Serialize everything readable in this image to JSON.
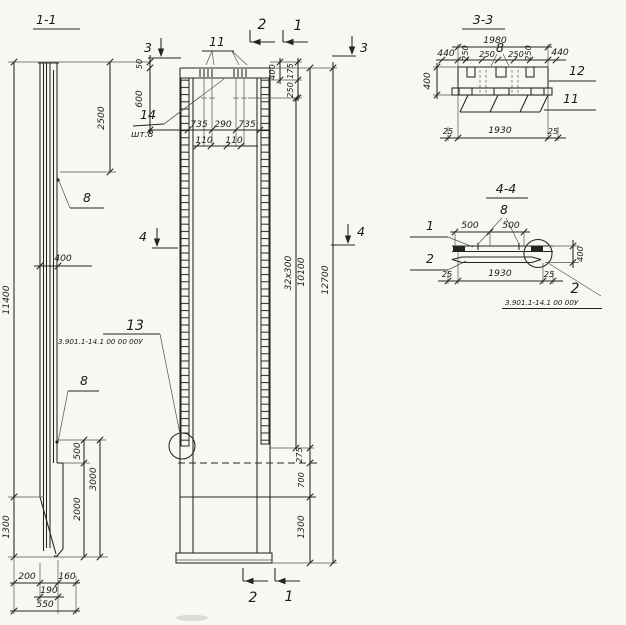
{
  "sheet": {
    "background": "#f8f7f2",
    "ink": "#26241f"
  },
  "section_1_1": {
    "title": "1-1",
    "label_rebar_top": "8",
    "label_rebar_bottom": "8",
    "dim_overall": "11400",
    "dim_top": "2500",
    "dim_width": "400",
    "dim_500": "500",
    "dim_2000": "2000",
    "dim_3000": "3000",
    "dim_1300": "1300",
    "dim_200": "200",
    "dim_160": "160",
    "dim_190": "190",
    "dim_550": "550"
  },
  "elevation": {
    "marker_3_left": "3",
    "marker_3_right": "3",
    "marker_2_top": "2",
    "marker_1_top": "1",
    "marker_4_left": "4",
    "marker_4_right": "4",
    "marker_2_bottom": "2",
    "marker_1_bottom": "1",
    "label_11": "11",
    "label_14": "14",
    "label_14_qty": "шт.8",
    "label_13": "13",
    "label_13_ref": "3.901.1-14.1 00 00 00У",
    "dim_50": "50",
    "dim_600": "600",
    "dim_735_left": "735",
    "dim_290": "290",
    "dim_735_right": "735",
    "dim_110_left": "110",
    "dim_110_right": "110",
    "dim_400": "400",
    "dim_175": "175",
    "dim_250": "250",
    "dim_ties": "32x300",
    "dim_10100": "10100",
    "dim_12700": "12700",
    "dim_275": "275",
    "dim_700": "700",
    "dim_1300": "1300"
  },
  "section_3_3": {
    "title": "3-3",
    "dim_1980": "1980",
    "dim_440_left": "440",
    "dim_440_right": "440",
    "dim_250_a": "250",
    "dim_250_b": "250",
    "dim_250_c": "250",
    "dim_250_d": "250",
    "label_8": "8",
    "dim_400": "400",
    "dim_25_left": "25",
    "dim_1930": "1930",
    "dim_25_right": "25",
    "label_12": "12",
    "label_11": "11"
  },
  "section_4_4": {
    "title": "4-4",
    "label_1": "1",
    "label_2": "2",
    "label_8": "8",
    "dim_500_left": "500",
    "dim_500_right": "500",
    "dim_400": "400",
    "dim_25_left": "25",
    "dim_1930": "1930",
    "dim_25_right": "25",
    "label_2_detail": "2",
    "label_ref": "3.901.1-14.1 00 00У"
  }
}
